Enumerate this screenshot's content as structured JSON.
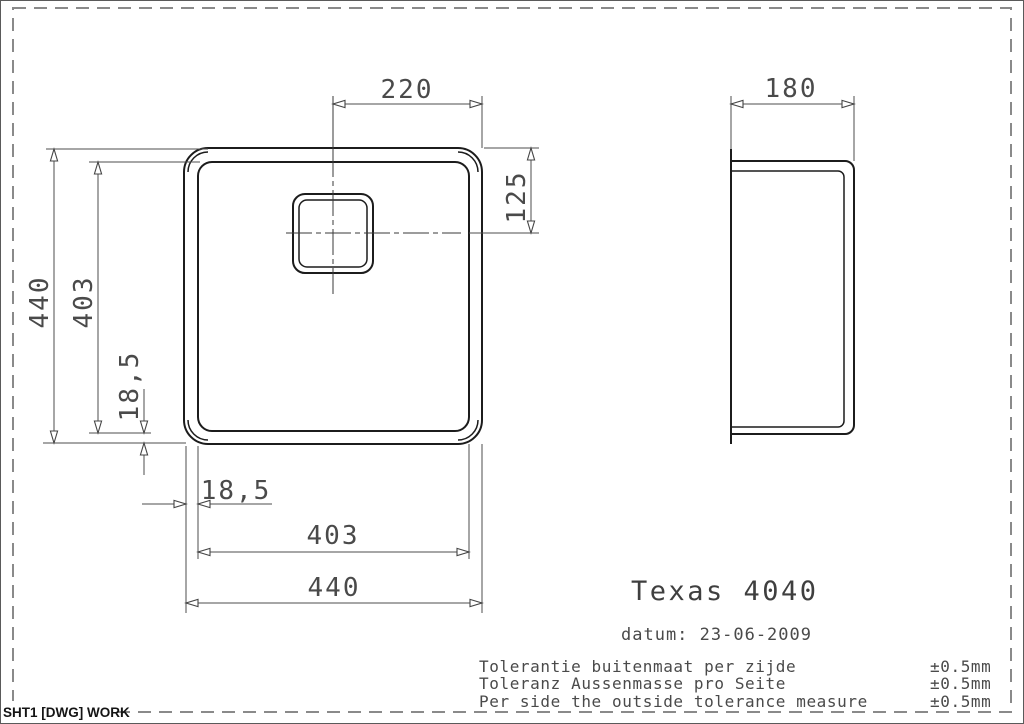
{
  "sheet": {
    "label": "SHT1 [DWG] WORK"
  },
  "title_block": {
    "title": "Texas 4040",
    "date": "datum: 23-06-2009"
  },
  "tolerances": [
    {
      "text": "Tolerantie buitenmaat per zijde",
      "value": "±0.5mm"
    },
    {
      "text": "Toleranz Aussenmasse pro Seite",
      "value": "±0.5mm"
    },
    {
      "text": "Per side the outside tolerance measure",
      "value": "±0.5mm"
    }
  ],
  "dims": {
    "top_half_width": "220",
    "drain_center_from_top": "125",
    "outer_height": "440",
    "bowl_height": "403",
    "rim_left_vertical": "18,5",
    "rim_bottom_horizontal": "18,5",
    "bowl_width": "403",
    "outer_width": "440",
    "depth": "180"
  },
  "colors": {
    "geometry": "#1c1c1c",
    "dimension": "#4d4d4d",
    "frame_dash": "#8a8a8a",
    "text": "#4a4a4a"
  }
}
